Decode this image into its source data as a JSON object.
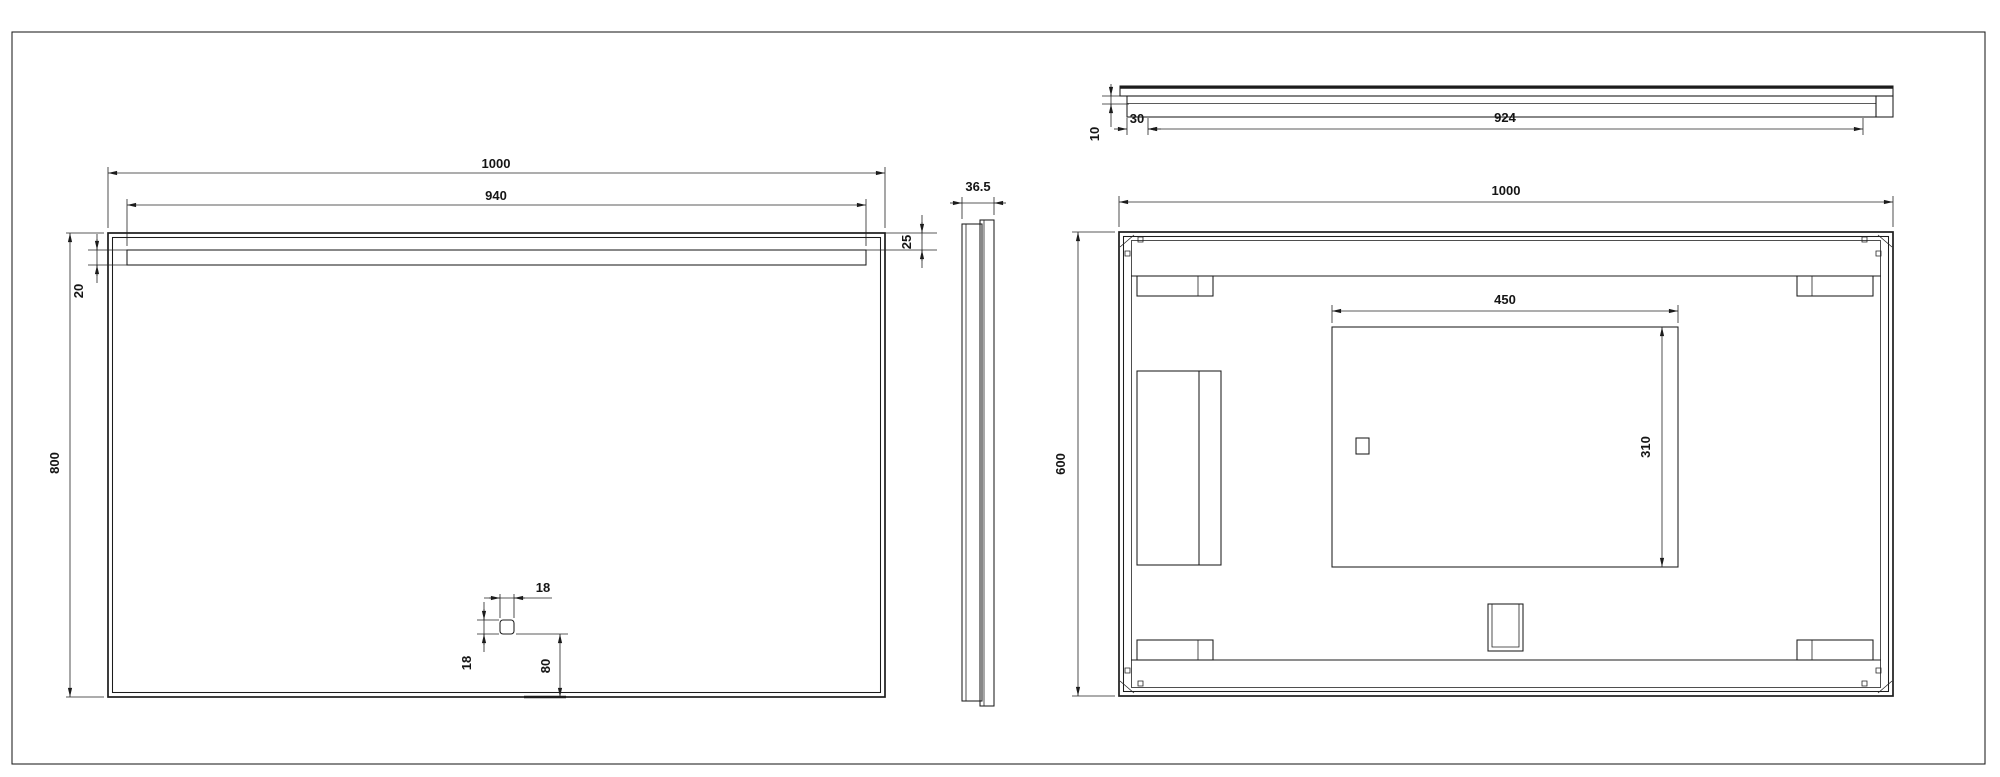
{
  "drawing": {
    "background": "#ffffff",
    "line_color": "#1c1c1c",
    "hatch_color": "#6e6e6e",
    "front_view": {
      "overall_width": "1000",
      "light_strip_width": "940",
      "strip_top_gap": "25",
      "strip_height": "20",
      "overall_height": "800",
      "sensor_width": "18",
      "sensor_height": "18",
      "sensor_bottom_offset": "80"
    },
    "side_view": {
      "depth": "36.5"
    },
    "top_view": {
      "glass_step": "10",
      "frame_side_inset": "30",
      "back_frame_width": "924"
    },
    "back_view": {
      "overall_width": "1000",
      "overall_height": "600",
      "mount_zone_width": "450",
      "mount_zone_height": "310"
    }
  }
}
